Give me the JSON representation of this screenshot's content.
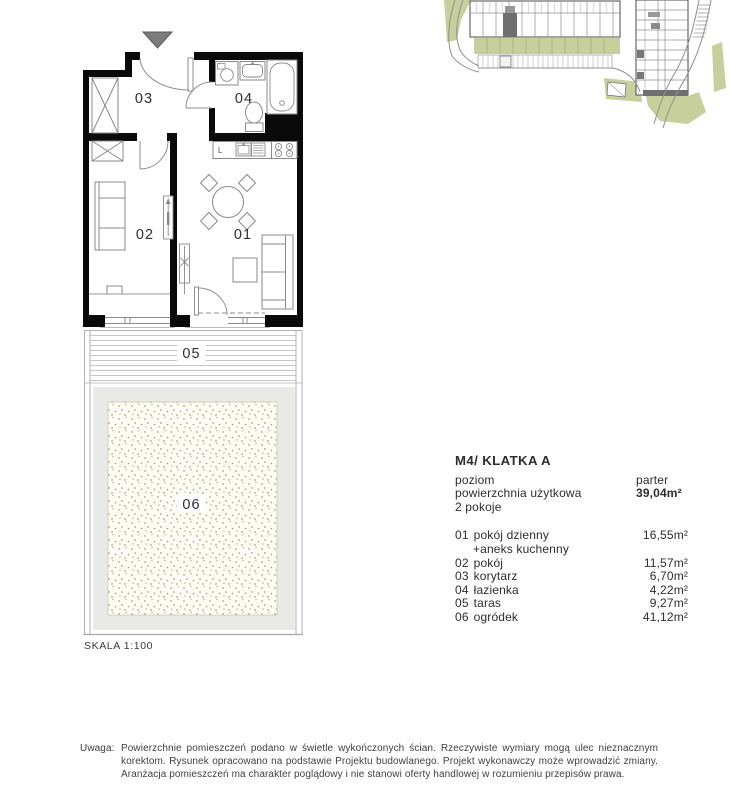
{
  "colors": {
    "wall": "#0a0a0a",
    "fixture_stroke": "#8a8a8a",
    "site_green": "#c7d09c",
    "highlight_unit": "#6f6f6f",
    "garden_band": "#e9e9e5",
    "garden_dots": "#aaa67c",
    "entrance_marker": "#7c7c7c"
  },
  "plan": {
    "labels": {
      "room01": "01",
      "room02": "02",
      "room03": "03",
      "room04": "04",
      "terrace": "05",
      "garden": "06",
      "kitchen_letter": "L"
    },
    "scale": "SKALA 1:100"
  },
  "info": {
    "title": "M4/ KLATKA A",
    "level_label": "poziom",
    "level_value": "parter",
    "area_label": "powierzchnia użytkowa",
    "area_value": "39,04m²",
    "rooms_count": "2 pokoje",
    "rooms": [
      {
        "num": "01",
        "name": "pokój dzienny",
        "name2": "+aneks kuchenny",
        "area": "16,55m²"
      },
      {
        "num": "02",
        "name": "pokój",
        "area": "11,57m²"
      },
      {
        "num": "03",
        "name": "korytarz",
        "area": "6,70m²"
      },
      {
        "num": "04",
        "name": "łazienka",
        "area": "4,22m²"
      },
      {
        "num": "05",
        "name": "taras",
        "area": "9,27m²"
      },
      {
        "num": "06",
        "name": "ogródek",
        "area": "41,12m²"
      }
    ]
  },
  "footer": {
    "label": "Uwaga:",
    "lines": [
      "Powierzchnie pomieszczeń podano w świetle wykończonych ścian. Rzeczywiste wymiary mogą ulec nieznacznym",
      "korektom. Rysunek opracowano na podstawie Projektu budowlanego. Projekt wykonawczy może wprowadzić zmiany.",
      "Aranżacja pomieszczeń ma charakter poglądowy i nie stanowi oferty handlowej w rozumieniu przepisów prawa."
    ]
  }
}
